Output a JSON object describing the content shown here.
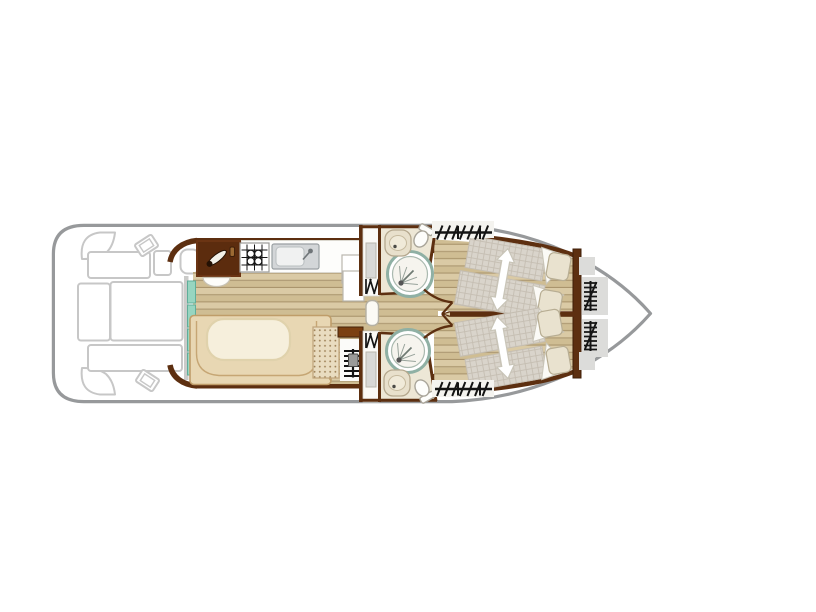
{
  "plan": {
    "type": "houseboat-deck-plan",
    "orientation": "bow-right",
    "visible_text": "",
    "rooms": [
      {
        "id": "aft-deck",
        "label": "Aft deck with seating",
        "fixtures": [
          "corner-seat-top",
          "corner-seat-bottom",
          "aft-bench-top",
          "aft-bench-bottom",
          "sofa-left",
          "sofa-right",
          "helm-seat",
          "co-pilot-seat",
          "speaker-top",
          "speaker-bottom"
        ]
      },
      {
        "id": "saloon-galley",
        "label": "Saloon and galley",
        "fixtures": [
          "entry-sliding-door",
          "galley-cabinet",
          "gas-lever",
          "gas-hob",
          "kitchen-sink",
          "worktop",
          "fridge-cabinets",
          "entry-step",
          "dinette-table",
          "u-shaped-bench",
          "upholstered-seat",
          "companionway-steps"
        ]
      },
      {
        "id": "shower-room-top",
        "label": "Shower room (top)",
        "fixtures": [
          "shower",
          "washbasin",
          "toilet",
          "storage-shelf",
          "louvered-door",
          "door-swing"
        ]
      },
      {
        "id": "shower-room-bottom",
        "label": "Shower room (bottom)",
        "fixtures": [
          "shower",
          "washbasin",
          "toilet",
          "storage-shelf",
          "louvered-door",
          "door-swing"
        ]
      },
      {
        "id": "corridor",
        "label": "Central corridor",
        "fixtures": [
          "cabin-door-leaf",
          "centerline-bulkhead"
        ]
      },
      {
        "id": "bow-cabin-top",
        "label": "Bow cabin (top)",
        "fixtures": [
          "double-bed",
          "bed-extension-arrow",
          "pillow",
          "pillow",
          "blanket",
          "blanket",
          "window-hatch"
        ]
      },
      {
        "id": "bow-cabin-bottom",
        "label": "Bow cabin (bottom)",
        "fixtures": [
          "double-bed",
          "bed-extension-arrow",
          "pillow",
          "pillow",
          "blanket",
          "blanket",
          "window-hatch"
        ]
      },
      {
        "id": "bow-deck",
        "label": "Bow deck",
        "fixtures": [
          "deck-mat-top",
          "deck-mat-bottom",
          "boarding-ladder-top",
          "boarding-ladder-bottom"
        ]
      }
    ]
  },
  "colors": {
    "background": "#ffffff",
    "hull_stroke": "#97999b",
    "furniture_outline": "#c7c7c7",
    "wall": "#5d2f10",
    "wall_dark": "#3f1f08",
    "wall_gray": "#cbcbc9",
    "wood_light": "#dacaa5",
    "wood_mid": "#cfbd93",
    "wood_line": "#aa956d",
    "counter": "#fdfdfb",
    "cabinet": "#6b3413",
    "cabinet_dark": "#431f06",
    "sink_body": "#d3d6d8",
    "sink_rim": "#9aa0a3",
    "door_teal": "#97d5c0",
    "door_teal_edge": "#5fae9a",
    "bench": "#e8d7b3",
    "bench_line": "#bf9d69",
    "table": "#f6efdc",
    "table_edge": "#e0d2ac",
    "seat_dot": "#9d8157",
    "seat_dot_bg": "#e9dcc0",
    "bath_floor": "#ede7d6",
    "shower_ring": "#8fb0a4",
    "fixture_line": "#a9a59a",
    "porcelain": "#fdfdfb",
    "basin_beige": "#e8e0cc",
    "mattress": "#d9d4cb",
    "mattress_line": "#c5beb2",
    "pillow": "#e9e2cf",
    "pillow_line": "#b7ad93",
    "blanket": "#fbfaf6",
    "blanket_line": "#c9c5b8",
    "rug": "#dcdcda",
    "symbol": "#141414",
    "metal": "#9a9a98",
    "shelf_gray": "#d8d8d6",
    "window_bg": "#f4f3ef"
  }
}
